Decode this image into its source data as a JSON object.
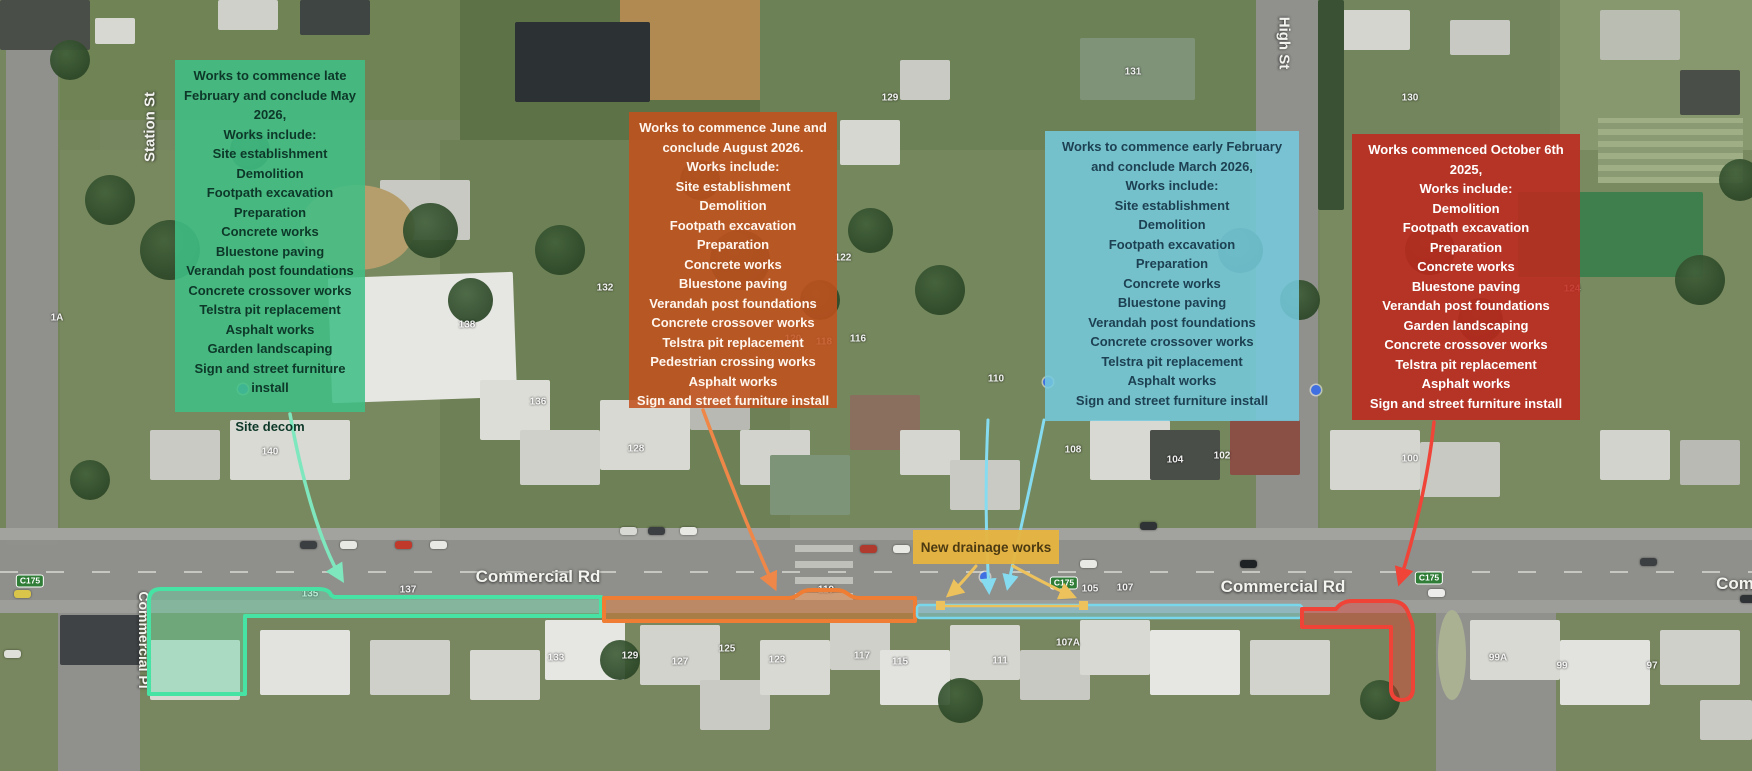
{
  "stages": [
    {
      "name": "stage-1-green",
      "box_color": "#3fbf86",
      "text_color": "#0d3829",
      "title": "Works to commence late February and conclude May 2026,",
      "lines": [
        "Works include:",
        "Site establishment",
        "Demolition",
        "Footpath excavation",
        "Preparation",
        "Concrete works",
        "Bluestone paving",
        "Verandah post foundations",
        "Concrete crossover works",
        "Telstra pit replacement",
        "Asphalt works",
        "Garden landscaping",
        "Sign and street furniture install"
      ],
      "footer": "Site decom"
    },
    {
      "name": "stage-2-orange",
      "box_color": "#c2511d",
      "text_color": "#fff6ee",
      "title": "Works to commence June and conclude August 2026.",
      "lines": [
        "Works include:",
        "Site establishment",
        "Demolition",
        "Footpath excavation",
        "Preparation",
        "Concrete works",
        "Bluestone paving",
        "Verandah post foundations",
        "Concrete crossover works",
        "Telstra pit replacement",
        "Pedestrian crossing works",
        "Asphalt works",
        "Sign and street furniture install"
      ],
      "footer": ""
    },
    {
      "name": "stage-3-blue",
      "box_color": "#74cade",
      "text_color": "#1d4152",
      "title": "Works to commence early February and conclude March 2026,",
      "lines": [
        "Works include:",
        "Site establishment",
        "Demolition",
        "Footpath excavation",
        "Preparation",
        "Concrete works",
        "Bluestone paving",
        "Verandah post foundations",
        "Concrete crossover works",
        "Telstra pit replacement",
        "Asphalt works",
        "Sign and street furniture install"
      ],
      "footer": ""
    },
    {
      "name": "stage-4-red",
      "box_color": "#c0271d",
      "text_color": "#ffffff",
      "title": "Works commenced October 6th 2025,",
      "lines": [
        "Works include:",
        "Demolition",
        "Footpath excavation",
        "Preparation",
        "Concrete works",
        "Bluestone paving",
        "Verandah post foundations",
        "Garden landscaping",
        "Concrete crossover works",
        "Telstra pit replacement",
        "Asphalt works",
        "Sign and street furniture install"
      ],
      "footer": ""
    }
  ],
  "drainage_label": {
    "text": "New drainage works",
    "bg_color": "#e7b43e",
    "text_color": "#4c3a12"
  },
  "street_labels": [
    {
      "text": "Station St",
      "x": 150,
      "y": 127,
      "rot": -90,
      "size": 15
    },
    {
      "text": "High St",
      "x": 1284,
      "y": 43,
      "rot": 90,
      "size": 15
    },
    {
      "text": "Commercial Rd",
      "x": 538,
      "y": 577,
      "rot": 0,
      "size": 17
    },
    {
      "text": "Commercial Rd",
      "x": 1283,
      "y": 587,
      "rot": 0,
      "size": 17
    },
    {
      "text": "Com",
      "x": 1735,
      "y": 584,
      "rot": 0,
      "size": 17
    },
    {
      "text": "Commercial Pl",
      "x": 144,
      "y": 640,
      "rot": 90,
      "size": 14
    }
  ],
  "route_badges": [
    {
      "text": "C175",
      "x": 30,
      "y": 581
    },
    {
      "text": "C175",
      "x": 1064,
      "y": 583
    },
    {
      "text": "C175",
      "x": 1429,
      "y": 578
    }
  ],
  "house_numbers": [
    {
      "x": 57,
      "y": 318,
      "text": "1A"
    },
    {
      "x": 270,
      "y": 452,
      "text": "140"
    },
    {
      "x": 467,
      "y": 325,
      "text": "138"
    },
    {
      "x": 538,
      "y": 402,
      "text": "136"
    },
    {
      "x": 605,
      "y": 288,
      "text": "132"
    },
    {
      "x": 636,
      "y": 449,
      "text": "128"
    },
    {
      "x": 843,
      "y": 258,
      "text": "122"
    },
    {
      "x": 890,
      "y": 98,
      "text": "129"
    },
    {
      "x": 1133,
      "y": 72,
      "text": "131"
    },
    {
      "x": 1410,
      "y": 98,
      "text": "130"
    },
    {
      "x": 793,
      "y": 339,
      "text": "120"
    },
    {
      "x": 824,
      "y": 342,
      "text": "118"
    },
    {
      "x": 858,
      "y": 339,
      "text": "116"
    },
    {
      "x": 996,
      "y": 379,
      "text": "110"
    },
    {
      "x": 1073,
      "y": 450,
      "text": "108"
    },
    {
      "x": 1175,
      "y": 460,
      "text": "104"
    },
    {
      "x": 1222,
      "y": 456,
      "text": "102"
    },
    {
      "x": 1410,
      "y": 459,
      "text": "100"
    },
    {
      "x": 1572,
      "y": 289,
      "text": "124"
    },
    {
      "x": 408,
      "y": 590,
      "text": "137"
    },
    {
      "x": 310,
      "y": 594,
      "text": "135"
    },
    {
      "x": 556,
      "y": 658,
      "text": "133"
    },
    {
      "x": 630,
      "y": 656,
      "text": "129"
    },
    {
      "x": 680,
      "y": 662,
      "text": "127"
    },
    {
      "x": 727,
      "y": 649,
      "text": "125"
    },
    {
      "x": 777,
      "y": 660,
      "text": "123"
    },
    {
      "x": 826,
      "y": 590,
      "text": "119"
    },
    {
      "x": 862,
      "y": 656,
      "text": "117"
    },
    {
      "x": 900,
      "y": 662,
      "text": "115"
    },
    {
      "x": 1000,
      "y": 661,
      "text": "111"
    },
    {
      "x": 1068,
      "y": 643,
      "text": "107A"
    },
    {
      "x": 1090,
      "y": 589,
      "text": "105"
    },
    {
      "x": 1125,
      "y": 588,
      "text": "107"
    },
    {
      "x": 1498,
      "y": 658,
      "text": "99A"
    },
    {
      "x": 1562,
      "y": 666,
      "text": "99"
    },
    {
      "x": 1652,
      "y": 666,
      "text": "97"
    }
  ],
  "map_markers": [
    {
      "x": 243,
      "y": 389
    },
    {
      "x": 1048,
      "y": 382
    },
    {
      "x": 1316,
      "y": 390
    },
    {
      "x": 985,
      "y": 577
    }
  ],
  "annotations": {
    "band_green": {
      "stroke": "#46e3a5",
      "fill": "rgba(96,220,165,0.38)"
    },
    "band_orange": {
      "stroke": "#ef7d33",
      "fill": "rgba(226,112,40,0.45)"
    },
    "band_blue": {
      "stroke": "#79d7ec",
      "fill": "rgba(130,215,235,0.45)"
    },
    "band_red": {
      "stroke": "#ef4338",
      "fill": "rgba(230,60,50,0.42)"
    },
    "arrow_green": "#7fe7bd",
    "arrow_orange": "#ef8748",
    "arrow_blue": "#85dcf0",
    "arrow_red": "#f04438",
    "arrow_yellow": "#edc25c"
  }
}
